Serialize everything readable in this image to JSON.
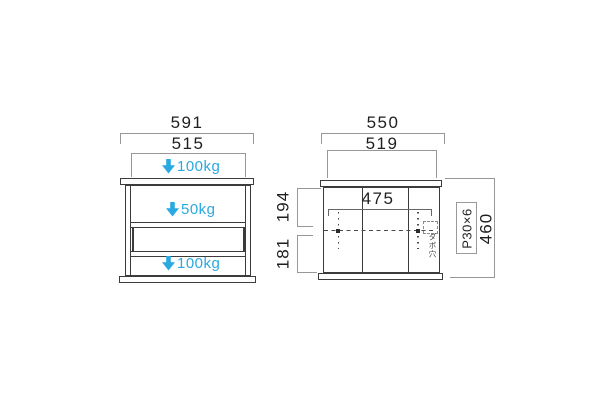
{
  "drawing": {
    "type": "furniture-dimension-diagram",
    "colors": {
      "accent_blue": "#2aa9e0",
      "object_line": "#3c3c3c",
      "dimension_line": "#979797",
      "text": "#1e1e1e"
    },
    "front_view": {
      "width_outer": "591",
      "width_inner": "515",
      "load_top": "100kg",
      "load_middle": "50kg",
      "load_bottom": "100kg"
    },
    "side_view": {
      "width_outer": "550",
      "width_inner": "519",
      "shelf_pitch_width": "475",
      "upper_section_height": "194",
      "lower_section_height": "181",
      "total_height": "460",
      "pitch_label": "P30×6",
      "pin_note": "ダボ穴"
    }
  }
}
